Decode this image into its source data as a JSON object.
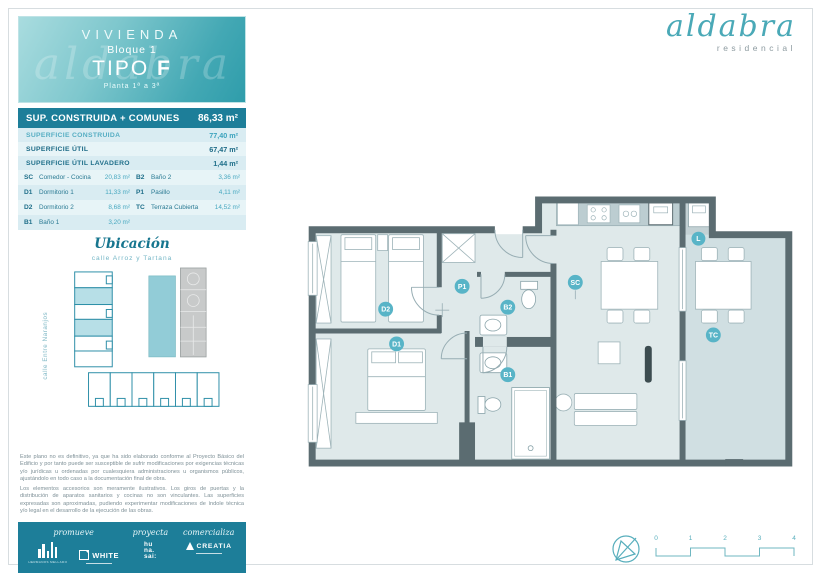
{
  "brand": {
    "name": "aldabra",
    "tagline": "residencial"
  },
  "header": {
    "building": "VIVIENDA",
    "block": "Bloque 1",
    "type_label": "TIPO",
    "type_letter": "F",
    "floors": "Planta 1ª a 3ª",
    "watermark": "aldabra"
  },
  "areas": {
    "total_label": "SUP. CONSTRUIDA + COMUNES",
    "total_value": "86,33 m²",
    "summary": [
      {
        "label": "SUPERFICIE CONSTRUIDA",
        "value": "77,40 m²"
      },
      {
        "label": "SUPERFICIE ÚTIL",
        "value": "67,47 m²"
      },
      {
        "label": "SUPERFICIE ÚTIL LAVADERO",
        "value": "1,44 m²"
      }
    ],
    "rooms_left": [
      {
        "code": "SC",
        "name": "Comedor - Cocina",
        "value": "20,83 m²"
      },
      {
        "code": "D1",
        "name": "Dormitorio 1",
        "value": "11,33 m²"
      },
      {
        "code": "D2",
        "name": "Dormitorio 2",
        "value": "8,68 m²"
      },
      {
        "code": "B1",
        "name": "Baño 1",
        "value": "3,20 m²"
      }
    ],
    "rooms_right": [
      {
        "code": "B2",
        "name": "Baño 2",
        "value": "3,36 m²"
      },
      {
        "code": "P1",
        "name": "Pasillo",
        "value": "4,11 m²"
      },
      {
        "code": "TC",
        "name": "Terraza Cubierta",
        "value": "14,52 m²"
      }
    ]
  },
  "location": {
    "title": "Ubicación",
    "subtitle": "calle Arroz y Tartana",
    "street_label": "calle Entre Naranjos"
  },
  "disclaimer": {
    "p1": "Este plano no es definitivo, ya que ha sido elaborado conforme al Proyecto Básico del Edificio y por tanto puede ser susceptible de sufrir modificaciones por exigencias técnicas y/o jurídicas u ordenadas por cualesquiera administraciones u organismos públicos, ajustándolo en todo caso a la documentación final de obra.",
    "p2": "Los elementos accesorios son meramente ilustrativos. Los giros de puertas y la distribución de aparatos sanitarios y cocinas no son vinculantes. Las superficies expresadas son aproximadas, pudiendo experimentar modificaciones de índole técnica y/o legal en el desarrollo de la ejecución de las obras."
  },
  "footer": {
    "roles": {
      "promueve": "promueve",
      "proyecta": "proyecta",
      "comercializa": "comercializa"
    },
    "logos": {
      "hermanos": "HERMANOS MELLADO",
      "white": "WHITE",
      "hunasai_1": "hu",
      "hunasai_2": "na.",
      "hunasai_3": "sai:",
      "creatia": "CREATIA"
    }
  },
  "plan": {
    "labels": {
      "d2": "D2",
      "d1": "D1",
      "p1": "P1",
      "b1": "B1",
      "b2": "B2",
      "sc": "SC",
      "l": "L",
      "tc": "TC"
    }
  },
  "scalebar": {
    "ticks": [
      "0",
      "1",
      "2",
      "3",
      "4"
    ]
  },
  "colors": {
    "accent_teal": "#1d7e99",
    "light_teal": "#5fb7c8",
    "wall": "#5b6c71"
  }
}
